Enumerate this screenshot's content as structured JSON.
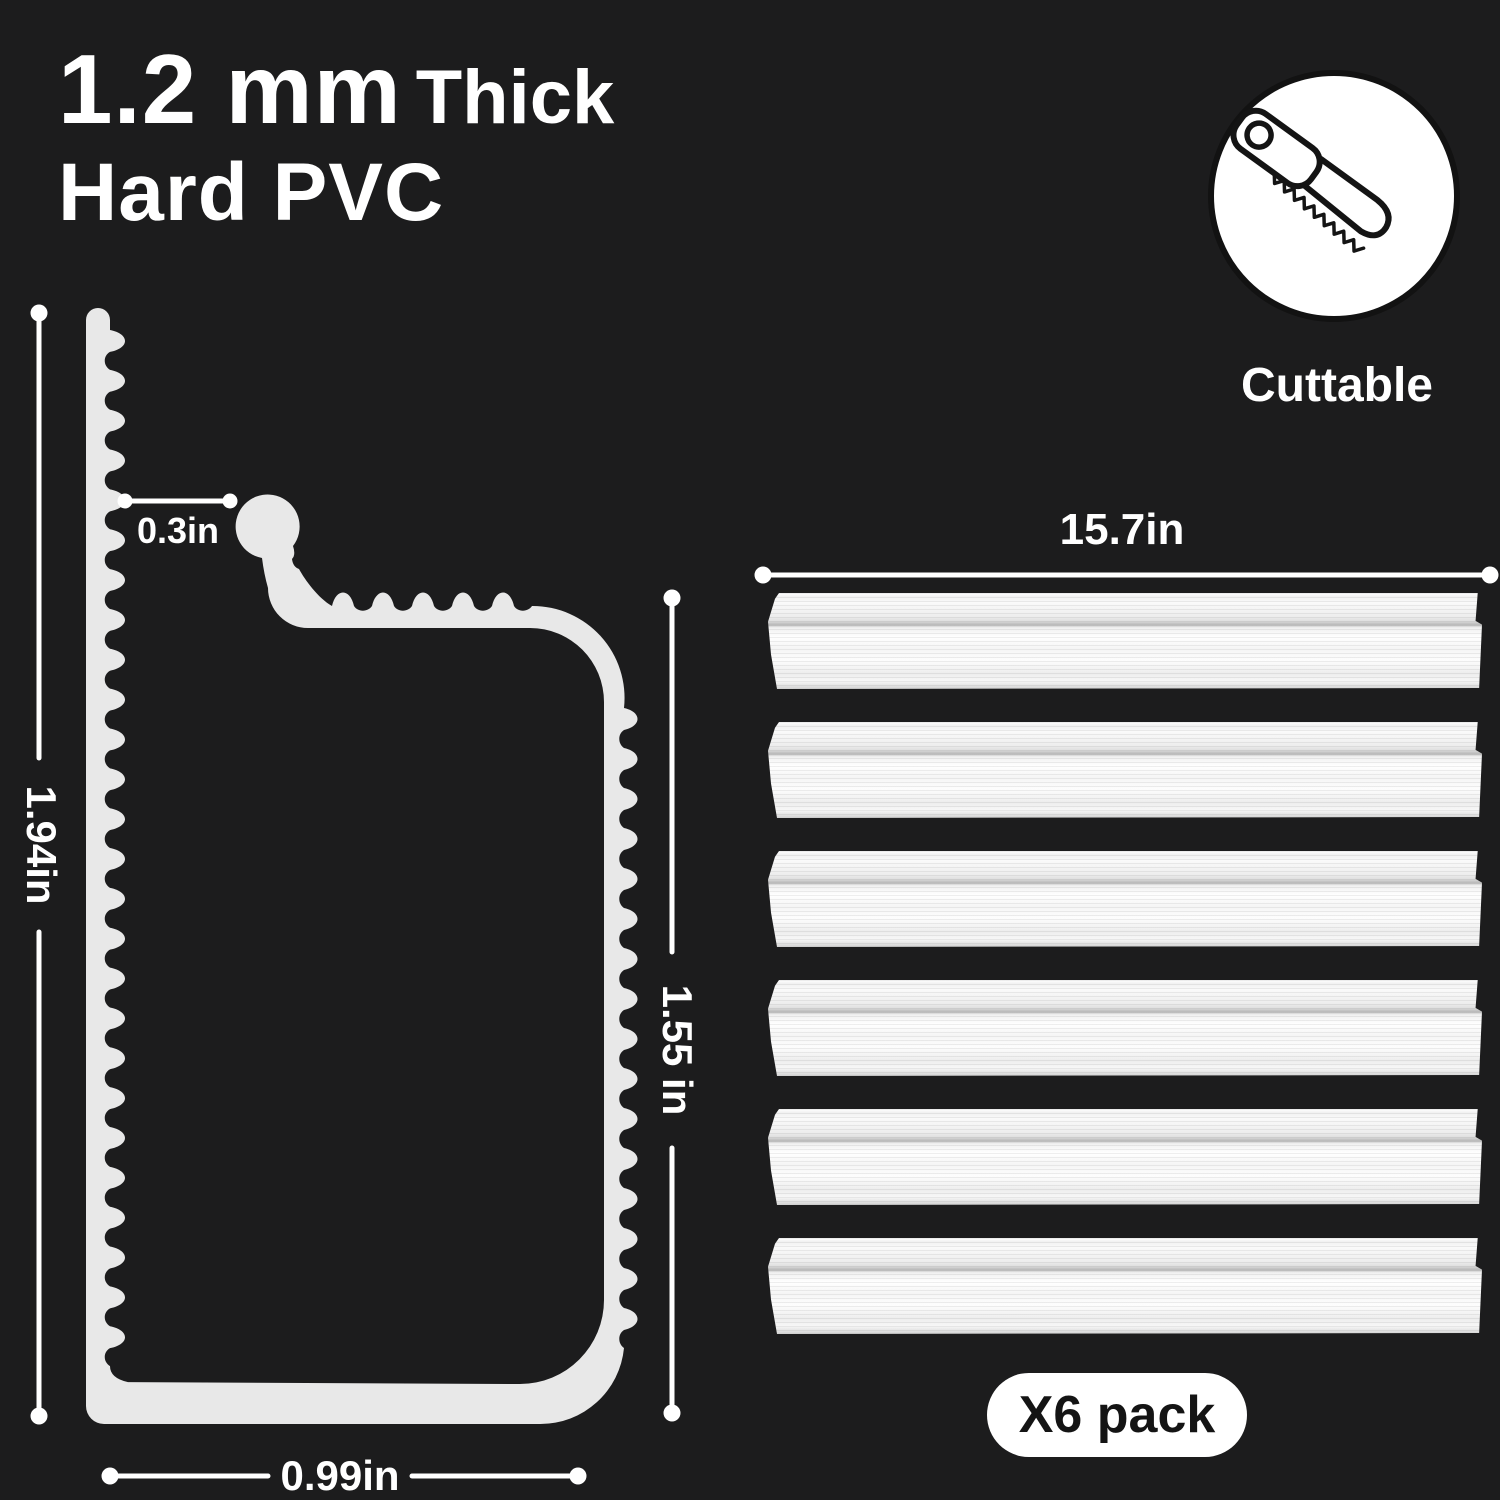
{
  "title": {
    "part1": "1.2 mm",
    "part2": "Thick",
    "line2": "Hard PVC"
  },
  "cuttable": {
    "label": "Cuttable",
    "icon": "saw-icon"
  },
  "profile_diagram": {
    "description": "PVC edge profile cross-section",
    "dimensions": {
      "gap": "0.3in",
      "total_height": "1.94in",
      "channel_height": "1.55 in",
      "base_width": "0.99in"
    }
  },
  "strips": {
    "length_label": "15.7in",
    "count": 6
  },
  "pack": {
    "label": "X6 pack"
  },
  "colors": {
    "background": "#1c1c1d",
    "text": "#ffffff",
    "profile_fill": "#e8e8e8",
    "dimension_line": "#ffffff",
    "strip_fill": "#f7f7f7",
    "badge_bg": "#ffffff",
    "badge_text": "#141414"
  }
}
